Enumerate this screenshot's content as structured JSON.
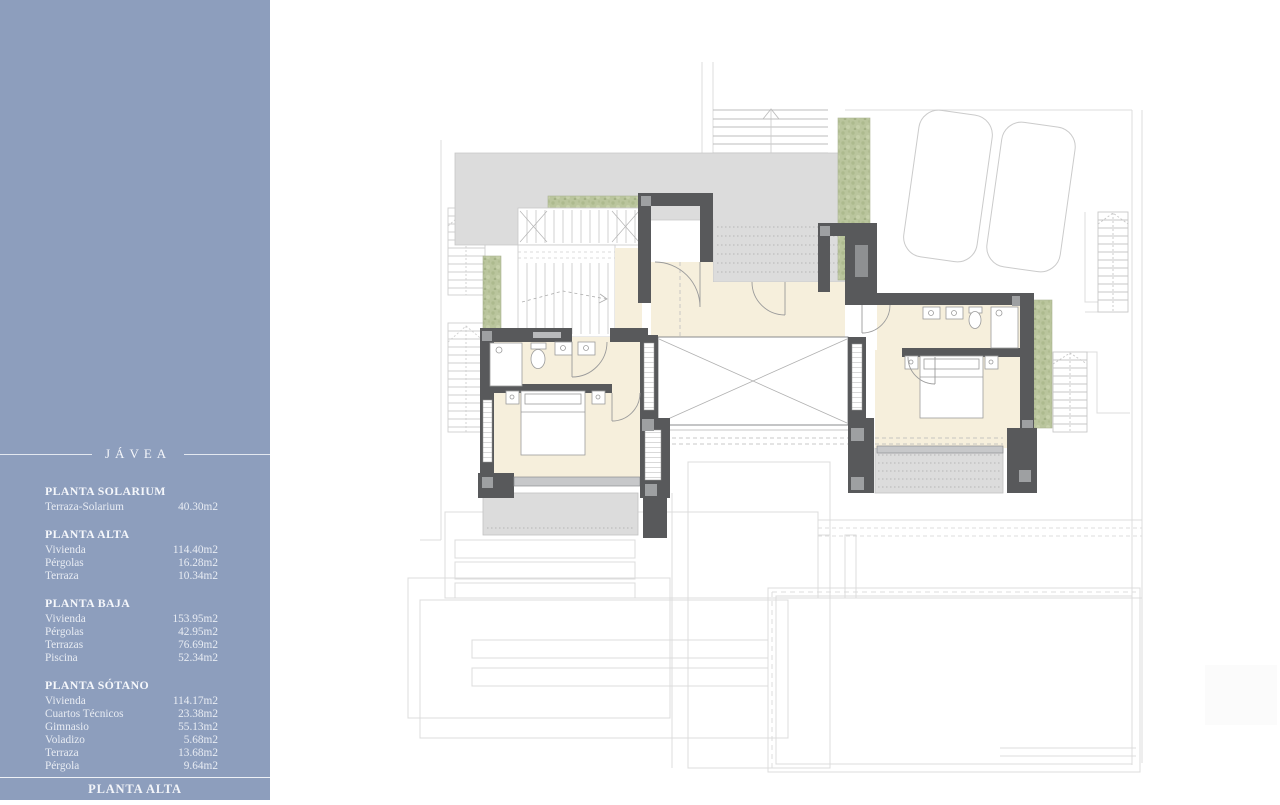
{
  "sidebar": {
    "project_title": "JÁVEA",
    "bg_color": "#8d9ebd",
    "text_color": "#edf0f6",
    "sections": [
      {
        "heading": "PLANTA SOLARIUM",
        "rows": [
          {
            "label": "Terraza-Solarium",
            "value": "40.30m2"
          }
        ]
      },
      {
        "heading": "PLANTA ALTA",
        "rows": [
          {
            "label": "Vivienda",
            "value": "114.40m2"
          },
          {
            "label": "Pérgolas",
            "value": "16.28m2"
          },
          {
            "label": "Terraza",
            "value": "10.34m2"
          }
        ]
      },
      {
        "heading": "PLANTA BAJA",
        "rows": [
          {
            "label": "Vivienda",
            "value": "153.95m2"
          },
          {
            "label": "Pérgolas",
            "value": "42.95m2"
          },
          {
            "label": "Terrazas",
            "value": "76.69m2"
          },
          {
            "label": "Piscina",
            "value": "52.34m2"
          }
        ]
      },
      {
        "heading": "PLANTA SÓTANO",
        "rows": [
          {
            "label": "Vivienda",
            "value": "114.17m2"
          },
          {
            "label": "Cuartos Técnicos",
            "value": "23.38m2"
          },
          {
            "label": "Gimnasio",
            "value": "55.13m2"
          },
          {
            "label": "Voladizo",
            "value": "5.68m2"
          },
          {
            "label": "Terraza",
            "value": "13.68m2"
          },
          {
            "label": "Pérgola",
            "value": "9.64m2"
          }
        ]
      }
    ],
    "footer_label": "PLANTA ALTA"
  },
  "plan": {
    "floor_shown": "Planta Alta (upper floor plan)",
    "colors": {
      "wall": "#58595b",
      "wall_insert": "#9ea0a2",
      "interior_floor": "#f6efdc",
      "terrace": "#dcdcdc",
      "planter_green": "#bac59d",
      "context_outline": "#dcdcdc",
      "fixture_stroke": "#9b9b9b"
    },
    "features": [
      "entry-steps",
      "roof-terrace",
      "interior-staircase",
      "foyer",
      "hallway",
      "bathroom-left",
      "bedroom-left",
      "bathroom-right",
      "bedroom-right",
      "double-height-void",
      "planters",
      "parking-two-cars",
      "exterior-stairs",
      "lower-floor-outlines",
      "pool-outline"
    ]
  }
}
